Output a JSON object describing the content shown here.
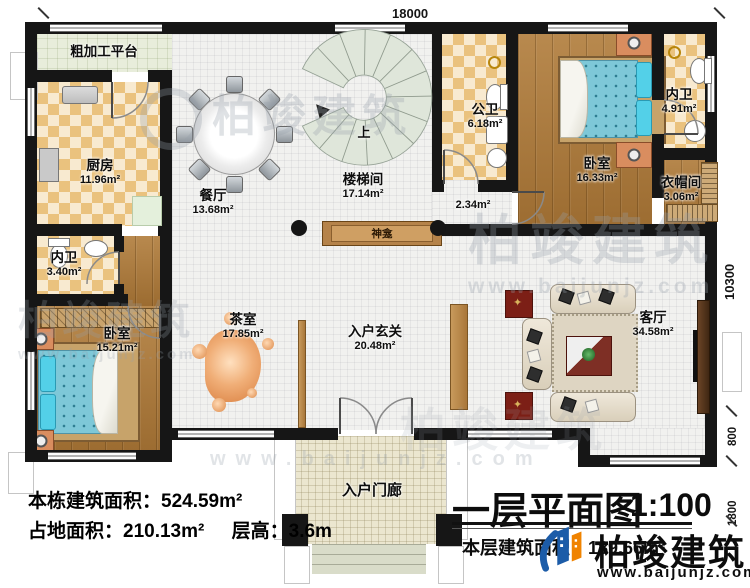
{
  "dims": {
    "width": "18000",
    "height": "10300",
    "offset": "800",
    "porch": "1800"
  },
  "rooms": {
    "platform": {
      "name": "粗加工平台"
    },
    "kitchen": {
      "name": "厨房",
      "area": "11.96m²"
    },
    "dining": {
      "name": "餐厅",
      "area": "13.68m²"
    },
    "stairhall": {
      "name": "楼梯间",
      "area": "17.14m²"
    },
    "pubbath": {
      "name": "公卫",
      "area": "6.18m²"
    },
    "passage": {
      "area": "2.34m²"
    },
    "bedroom_ne": {
      "name": "卧室",
      "area": "16.33m²"
    },
    "bath_ne": {
      "name": "内卫",
      "area": "4.91m²"
    },
    "cloak": {
      "name": "衣帽间",
      "area": "3.06m²"
    },
    "bath_w": {
      "name": "内卫",
      "area": "3.40m²"
    },
    "bedroom_sw": {
      "name": "卧室",
      "area": "15.21m²"
    },
    "tearoom": {
      "name": "茶室",
      "area": "17.85m²"
    },
    "foyer": {
      "name": "入户玄关",
      "area": "20.48m²"
    },
    "living": {
      "name": "客厅",
      "area": "34.58m²"
    },
    "porch": {
      "name": "入户门廊"
    }
  },
  "annotations": {
    "up": "上",
    "shrine": "神龛"
  },
  "info": {
    "building": "本栋建筑面积：524.59m²",
    "site": "占地面积：210.13m²",
    "height": "层高：3.6m"
  },
  "titleblock": {
    "title": "一层平面图",
    "scale": "1:100",
    "floor_area": "本层建筑面积：189.66m²"
  },
  "brand": {
    "name": "柏竣建筑",
    "site": "www.baijunjz.com"
  },
  "colors": {
    "wall": "#161616",
    "wood": "#a9783c",
    "checker": "#eac27e",
    "brand_blue": "#1c5ca8",
    "brand_orange": "#f08300"
  }
}
